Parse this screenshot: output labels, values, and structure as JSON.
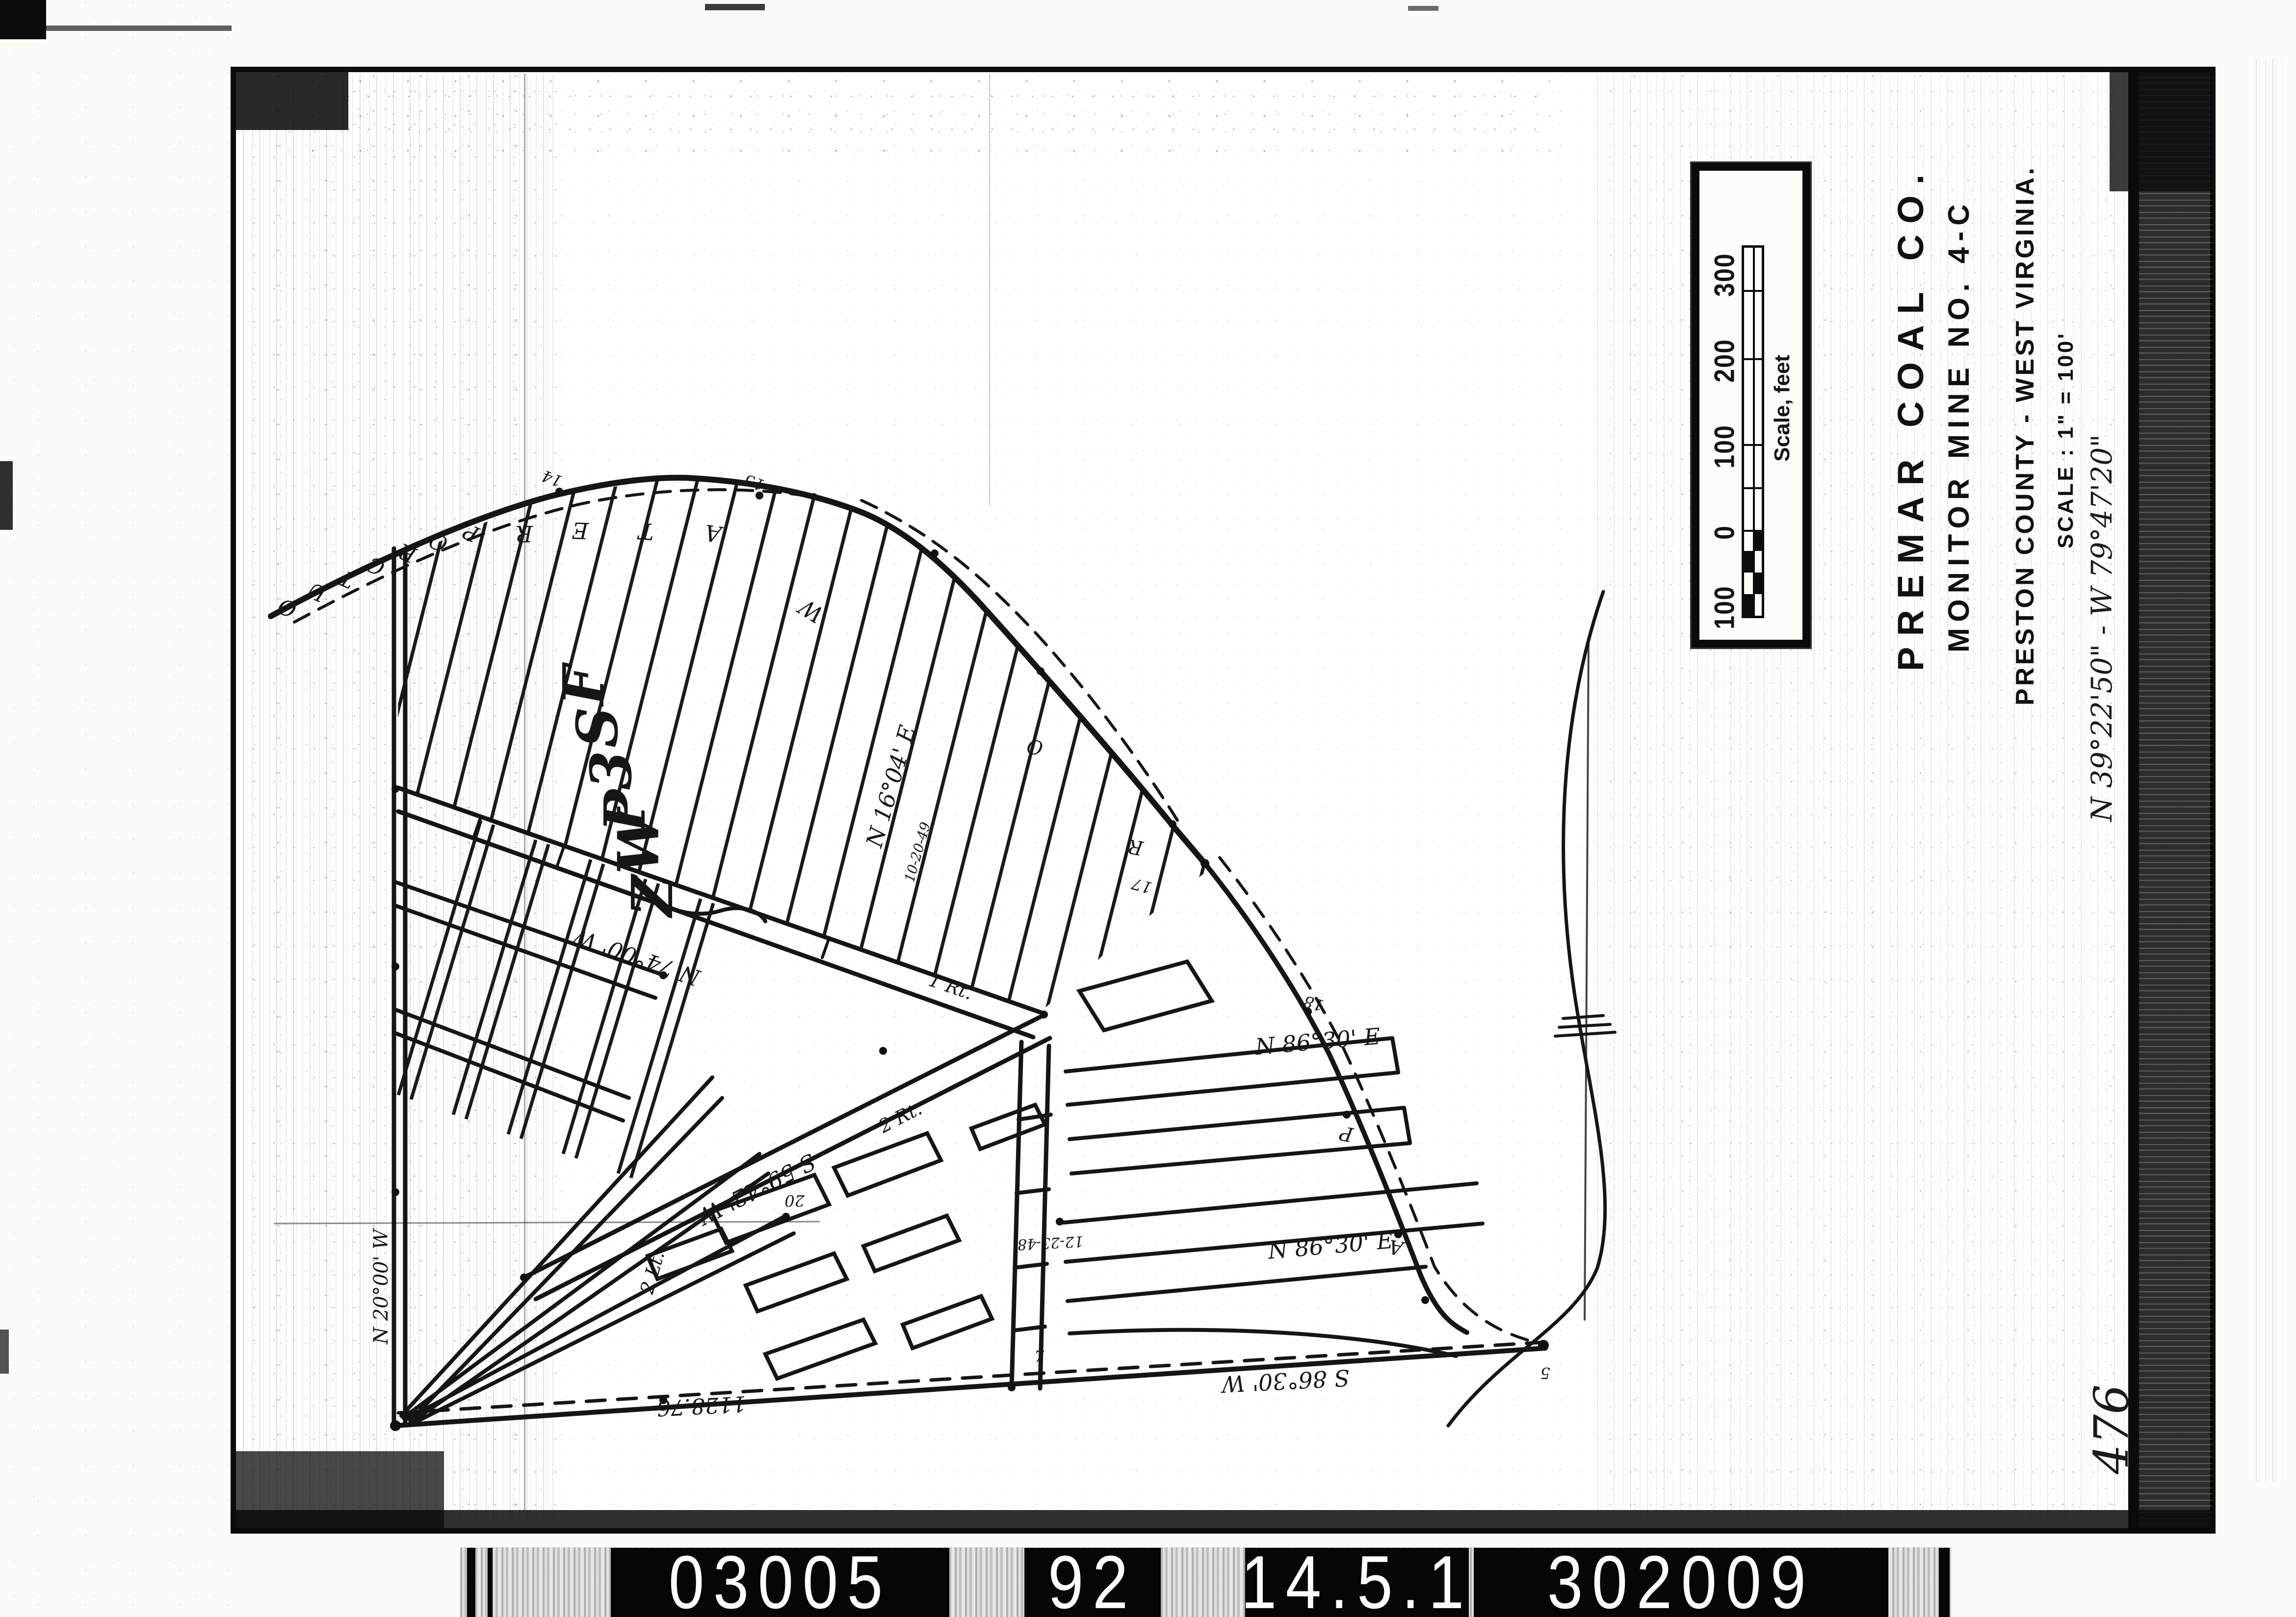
{
  "title_block": {
    "company": "PREMAR COAL CO.",
    "mine": "MONITOR MINE NO. 4-C",
    "location": "PRESTON COUNTY - WEST VIRGINIA.",
    "scale_note": "SCALE : 1\" = 100'"
  },
  "margin_notes": {
    "coordinates": "N 39°22'50\" - W 79°47'20\"",
    "sheet_number": "476"
  },
  "scale_bar": {
    "caption": "Scale, feet",
    "tick_labels": [
      "100",
      "0",
      "100",
      "200",
      "300"
    ]
  },
  "film_strip": {
    "groups": [
      "03005",
      "92",
      "14.5.1",
      "302009"
    ]
  },
  "map": {
    "outcrop_letters": [
      "O",
      "U",
      "T",
      "C",
      "R",
      "O",
      "P"
    ],
    "water_letters": [
      "W",
      "A",
      "T",
      "E",
      "R"
    ],
    "large_letters": [
      "F",
      "S",
      "3",
      "P",
      "W",
      "Z"
    ],
    "bearing_n1604e": "N 16°04' E",
    "bearing_n7400w": "N 74°00' W",
    "bearing_s5942w": "S 59°42' W",
    "bearing_n8630e_upper": "N 86°30' E",
    "bearing_n8630e_lower": "N 86°30' E",
    "bearing_s8630w": "S 86°30' W",
    "bearing_n2000w": "N 20°00' W",
    "distance_bottom": "1128.76",
    "date_1": "12-23-48",
    "date_2": "10-20-49",
    "entry_1": "1 Rt.",
    "entry_2": "2 Rt.",
    "entry_3": "2 Lt.",
    "stations": {
      "s14": "14",
      "s15": "15",
      "s17": "17",
      "s18": "18",
      "s7": "7",
      "s5": "5",
      "s20": "20"
    },
    "boundary_letters": {
      "o": "O",
      "r": "R",
      "p": "P",
      "a": "A"
    }
  }
}
